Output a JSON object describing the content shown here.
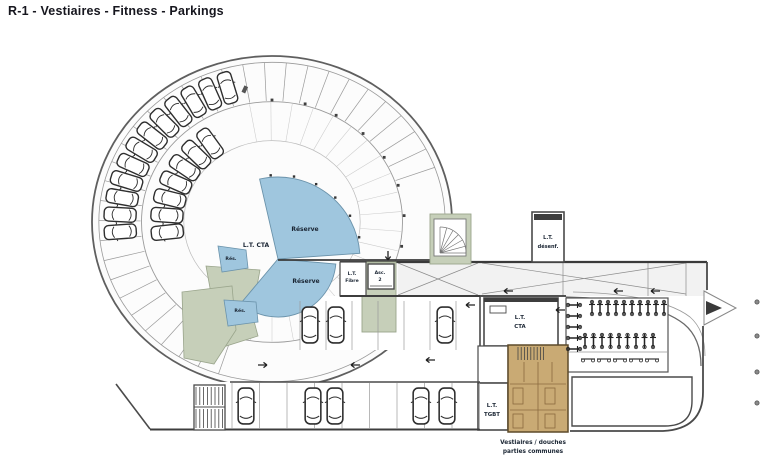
{
  "title": "R-1 - Vestiaires - Fitness - Parkings",
  "labels": {
    "reserve_upper": "Réserve",
    "reserve_lower": "Réserve",
    "lt_cta_center": "L.T. CTA",
    "res_1": "Rés.",
    "res_2": "Rés.",
    "lt_fibre_1": "L.T.",
    "lt_fibre_2": "Fibre",
    "asc_1": "Asc.",
    "asc_2": "2",
    "desenf_1": "L.T.",
    "desenf_2": "désenf.",
    "cta_right_1": "L.T.",
    "cta_right_2": "CTA",
    "tgbt_1": "L.T.",
    "tgbt_2": "TGBT"
  },
  "caption": {
    "line1": "Vestiaires / douches",
    "line2": "parties communes"
  },
  "colors": {
    "reserve_blue": "#9fc6de",
    "technical_green": "#c6cfb9",
    "vestiaire_tan": "#c9aa74",
    "wall_dark": "#3d3d3d",
    "caption_brown": "#7a3a2a",
    "title_dark": "#16161e"
  },
  "plan": {
    "ring": {
      "cx": 272,
      "cy": 222,
      "rx": 180,
      "ry": 166,
      "rings": [
        {
          "f": 1.0,
          "stroke": "#5f5f5f",
          "w": 1.8,
          "fill": "#fcfcfc"
        },
        {
          "f": 0.962,
          "stroke": "#9a9a9a",
          "w": 0.8,
          "fill": "none"
        },
        {
          "f": 0.725,
          "stroke": "#9a9a9a",
          "w": 0.9,
          "fill": "none"
        },
        {
          "f": 0.49,
          "stroke": "#bcbcbc",
          "w": 0.7,
          "fill": "none"
        }
      ],
      "bays": {
        "from": -20,
        "to": -252,
        "step": -7.25,
        "r1": 0.73,
        "r2": 0.962
      },
      "fan": {
        "from": -100,
        "to": 128,
        "step": 9.5,
        "r1": 0.49,
        "r2": 0.72
      },
      "ticks": {
        "from": -90,
        "to": 55,
        "step": 14.5,
        "r": 0.735
      },
      "outer_cars": {
        "angles": [
          -184,
          -177,
          -170,
          -163,
          -156,
          -149,
          -142,
          -135,
          -128,
          -121,
          -114,
          -107
        ],
        "r": 0.845
      },
      "inner_cars": {
        "angles": [
          -186,
          -176,
          -166,
          -156,
          -146,
          -136,
          -126
        ],
        "r": 0.585
      }
    },
    "hub_ticks": {
      "from": -95,
      "to": -12,
      "step": 16,
      "r": 84
    },
    "bays_upper": {
      "x1": 300,
      "x2": 478,
      "step": 26,
      "y1": 301,
      "y2": 350
    },
    "bays_lower": {
      "x1": 232,
      "x2": 480,
      "step": 27.5,
      "y1": 383,
      "y2": 429
    },
    "cars_upper": [
      310,
      336,
      445
    ],
    "cars_upper_y": 325,
    "cars_lower": [
      246,
      313,
      335,
      421,
      447
    ],
    "cars_lower_y": 406,
    "bikes_row1": {
      "x1": 592,
      "n": 10,
      "dx": 8,
      "y": 308
    },
    "bikes_row2": {
      "x1": 585,
      "n": 9,
      "dx": 8.5,
      "y": 341
    },
    "bikes_col": {
      "x": 574,
      "y1": 305,
      "n": 5,
      "dy": 11
    },
    "bikes_bottom": {
      "x1": 588,
      "n": 5,
      "dx": 16,
      "y": 359
    },
    "arrows": [
      {
        "x": 508,
        "y": 291,
        "r": 180
      },
      {
        "x": 618,
        "y": 291,
        "r": 180
      },
      {
        "x": 655,
        "y": 291,
        "r": 180
      },
      {
        "x": 263,
        "y": 365,
        "r": 0
      },
      {
        "x": 355,
        "y": 365,
        "r": 180
      },
      {
        "x": 430,
        "y": 360,
        "r": 180
      },
      {
        "x": 388,
        "y": 256,
        "r": 90
      },
      {
        "x": 470,
        "y": 305,
        "r": 180
      },
      {
        "x": 560,
        "y": 310,
        "r": 180
      }
    ],
    "dots": [
      {
        "x": 757,
        "y": 302
      },
      {
        "x": 757,
        "y": 336
      },
      {
        "x": 757,
        "y": 372
      },
      {
        "x": 757,
        "y": 403
      }
    ],
    "hatches": [
      {
        "x": 196,
        "y": 387,
        "w": 27,
        "h": 18,
        "step": 3.8
      },
      {
        "x": 196,
        "y": 409,
        "w": 27,
        "h": 19,
        "step": 3.8
      },
      {
        "x": 518,
        "y": 347,
        "w": 28,
        "h": 13,
        "step": 3.2
      }
    ]
  }
}
